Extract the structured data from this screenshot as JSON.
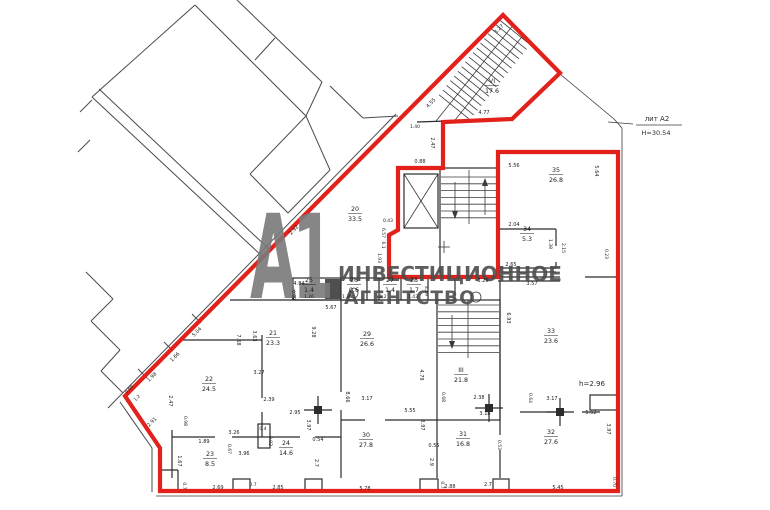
{
  "colors": {
    "outline_red": "#e3211b",
    "walls": "#2c2c2c",
    "old_building_walls": "#4a4a4a",
    "watermark_gray": "#7a7a7a",
    "watermark_text_gray": "#4d4d4d",
    "shaft_fill": "#4f4f4f",
    "background": "#ffffff"
  },
  "watermark": {
    "logo": "А1",
    "line1": "ИНВЕСТИЦИОННОЕ",
    "line2": "АГЕНТСТВО"
  },
  "annotations": [
    {
      "t": "лит  А2",
      "x": 657,
      "y": 121,
      "r": 0,
      "s": 7
    },
    {
      "t": "H=30.54",
      "x": 656,
      "y": 135,
      "r": 0,
      "s": 6.5
    },
    {
      "t": "h=2.96",
      "x": 592,
      "y": 386,
      "r": 0,
      "s": 7
    }
  ],
  "labels": {
    "rooms": [
      {
        "num": "VI",
        "area": "17.6",
        "x": 492,
        "y": 83
      },
      {
        "num": "20",
        "area": "33.5",
        "x": 355,
        "y": 211
      },
      {
        "num": "35",
        "area": "26.8",
        "x": 556,
        "y": 172
      },
      {
        "num": "34",
        "area": "5.3",
        "x": 527,
        "y": 231
      },
      {
        "num": "25",
        "area": "1.4",
        "x": 309,
        "y": 282
      },
      {
        "num": "26",
        "area": "0.6",
        "x": 354,
        "y": 282
      },
      {
        "num": "27",
        "area": "1.4",
        "x": 390,
        "y": 282
      },
      {
        "num": "28",
        "area": "1.7",
        "x": 414,
        "y": 282
      },
      {
        "num": "21",
        "area": "23.3",
        "x": 273,
        "y": 335
      },
      {
        "num": "29",
        "area": "26.6",
        "x": 367,
        "y": 336
      },
      {
        "num": "33",
        "area": "23.6",
        "x": 551,
        "y": 333
      },
      {
        "num": "22",
        "area": "24.5",
        "x": 209,
        "y": 381
      },
      {
        "num": "III",
        "area": "21.8",
        "x": 461,
        "y": 372
      },
      {
        "num": "30",
        "area": "27.8",
        "x": 366,
        "y": 437
      },
      {
        "num": "31",
        "area": "16.8",
        "x": 463,
        "y": 436
      },
      {
        "num": "32",
        "area": "27.6",
        "x": 551,
        "y": 434
      },
      {
        "num": "23",
        "area": "8.5",
        "x": 210,
        "y": 456
      },
      {
        "num": "24",
        "area": "14.6",
        "x": 286,
        "y": 445
      }
    ],
    "dims": [
      {
        "t": "3.27",
        "x": 500,
        "y": 30,
        "r": -45
      },
      {
        "t": "4.55",
        "x": 432,
        "y": 104,
        "r": -45
      },
      {
        "t": "4.77",
        "x": 484,
        "y": 114
      },
      {
        "t": "1.40",
        "x": 415,
        "y": 128,
        "s": 4.5
      },
      {
        "t": "2.47",
        "x": 431,
        "y": 143,
        "r": 90
      },
      {
        "t": "0.88",
        "x": 420,
        "y": 163
      },
      {
        "t": "2.92",
        "x": 295,
        "y": 231,
        "r": -45
      },
      {
        "t": "0.43",
        "x": 388,
        "y": 222,
        "s": 4.5
      },
      {
        "t": "6.57",
        "x": 382,
        "y": 233,
        "r": 90,
        "s": 4.5
      },
      {
        "t": "6.1",
        "x": 382,
        "y": 245,
        "r": 90,
        "s": 4.5
      },
      {
        "t": "1.93",
        "x": 378,
        "y": 258,
        "r": 90,
        "s": 4.5
      },
      {
        "t": "5.56",
        "x": 514,
        "y": 167
      },
      {
        "t": "5.64",
        "x": 595,
        "y": 171,
        "r": 90
      },
      {
        "t": "2.04",
        "x": 514,
        "y": 226
      },
      {
        "t": "1.38",
        "x": 549,
        "y": 244,
        "r": 90,
        "s": 4.5
      },
      {
        "t": "2.15",
        "x": 562,
        "y": 248,
        "r": 90,
        "s": 4.5
      },
      {
        "t": "0.23",
        "x": 605,
        "y": 254,
        "r": 90,
        "s": 4.5
      },
      {
        "t": "2.65",
        "x": 511,
        "y": 266
      },
      {
        "t": "3.57",
        "x": 532,
        "y": 285
      },
      {
        "t": "6.93",
        "x": 507,
        "y": 318,
        "r": 90
      },
      {
        "t": "3.29",
        "x": 483,
        "y": 282
      },
      {
        "t": "5.67",
        "x": 331,
        "y": 309
      },
      {
        "t": "4.84",
        "x": 299,
        "y": 285
      },
      {
        "t": "0.98",
        "x": 292,
        "y": 295,
        "r": 90,
        "s": 4.5
      },
      {
        "t": "1.26",
        "x": 309,
        "y": 298,
        "s": 4.5
      },
      {
        "t": "1.38",
        "x": 347,
        "y": 298,
        "s": 4.5
      },
      {
        "t": "1.2",
        "x": 383,
        "y": 298,
        "s": 4.5
      },
      {
        "t": "1.43",
        "x": 413,
        "y": 298,
        "s": 4.5
      },
      {
        "t": "4.19",
        "x": 425,
        "y": 291,
        "r": 90,
        "s": 4.5
      },
      {
        "t": "9.28",
        "x": 312,
        "y": 332,
        "r": 90
      },
      {
        "t": "7.68",
        "x": 237,
        "y": 340,
        "r": 90
      },
      {
        "t": "3.63",
        "x": 253,
        "y": 336,
        "r": 90
      },
      {
        "t": "3.27",
        "x": 259,
        "y": 374
      },
      {
        "t": "2.39",
        "x": 269,
        "y": 401
      },
      {
        "t": "5.04",
        "x": 198,
        "y": 333,
        "r": -45
      },
      {
        "t": "1.66",
        "x": 176,
        "y": 358,
        "r": -45
      },
      {
        "t": "1.98",
        "x": 153,
        "y": 378,
        "r": -45
      },
      {
        "t": "0.65",
        "x": 130,
        "y": 390,
        "r": -45,
        "s": 4.5
      },
      {
        "t": "1.2",
        "x": 138,
        "y": 399,
        "r": -45,
        "s": 4.5
      },
      {
        "t": "2.47",
        "x": 169,
        "y": 401,
        "r": 90
      },
      {
        "t": "2.91",
        "x": 153,
        "y": 423,
        "r": -45
      },
      {
        "t": "0.98",
        "x": 184,
        "y": 421,
        "r": 90,
        "s": 4.5
      },
      {
        "t": "1.89",
        "x": 204,
        "y": 443
      },
      {
        "t": "0.67",
        "x": 228,
        "y": 449,
        "r": 90,
        "s": 4.5
      },
      {
        "t": "3.26",
        "x": 234,
        "y": 434
      },
      {
        "t": "3.96",
        "x": 244,
        "y": 455
      },
      {
        "t": "0.4",
        "x": 263,
        "y": 430,
        "s": 4.5
      },
      {
        "t": "0.92",
        "x": 269,
        "y": 441,
        "r": 90,
        "s": 4.5
      },
      {
        "t": "1.67",
        "x": 178,
        "y": 461,
        "r": 90
      },
      {
        "t": "0.7",
        "x": 183,
        "y": 486,
        "r": 90,
        "s": 4.5
      },
      {
        "t": "2.69",
        "x": 218,
        "y": 489
      },
      {
        "t": "0.7",
        "x": 253,
        "y": 486,
        "s": 4.5
      },
      {
        "t": "2.85",
        "x": 278,
        "y": 489
      },
      {
        "t": "5.78",
        "x": 365,
        "y": 490
      },
      {
        "t": "2.95",
        "x": 295,
        "y": 414
      },
      {
        "t": "3.97",
        "x": 307,
        "y": 425,
        "r": 90
      },
      {
        "t": "0.54",
        "x": 318,
        "y": 441
      },
      {
        "t": "2.7",
        "x": 315,
        "y": 463,
        "r": 90
      },
      {
        "t": "3.17",
        "x": 367,
        "y": 400
      },
      {
        "t": "8.66",
        "x": 346,
        "y": 397,
        "r": 90
      },
      {
        "t": "4.79",
        "x": 420,
        "y": 375,
        "r": 90
      },
      {
        "t": "5.55",
        "x": 410,
        "y": 412
      },
      {
        "t": "3.97",
        "x": 421,
        "y": 425,
        "r": 90
      },
      {
        "t": "0.55",
        "x": 434,
        "y": 447
      },
      {
        "t": "2.9",
        "x": 430,
        "y": 462,
        "r": 90
      },
      {
        "t": "0.68",
        "x": 442,
        "y": 397,
        "r": 90,
        "s": 4.5
      },
      {
        "t": "2.38",
        "x": 479,
        "y": 399
      },
      {
        "t": "3.16",
        "x": 485,
        "y": 415
      },
      {
        "t": "0.53",
        "x": 498,
        "y": 445,
        "r": 90,
        "s": 4.5
      },
      {
        "t": "0.64",
        "x": 529,
        "y": 398,
        "r": 90,
        "s": 4.5
      },
      {
        "t": "3.17",
        "x": 552,
        "y": 400
      },
      {
        "t": "5.52",
        "x": 591,
        "y": 414
      },
      {
        "t": "3.97",
        "x": 607,
        "y": 429,
        "r": 90
      },
      {
        "t": "0.70",
        "x": 613,
        "y": 482,
        "r": 90,
        "s": 4.5
      },
      {
        "t": "5.45",
        "x": 558,
        "y": 489
      },
      {
        "t": "2.7",
        "x": 488,
        "y": 486
      },
      {
        "t": "2.88",
        "x": 450,
        "y": 488
      },
      {
        "t": "0.7",
        "x": 441,
        "y": 485,
        "r": 90,
        "s": 4.5
      }
    ]
  }
}
